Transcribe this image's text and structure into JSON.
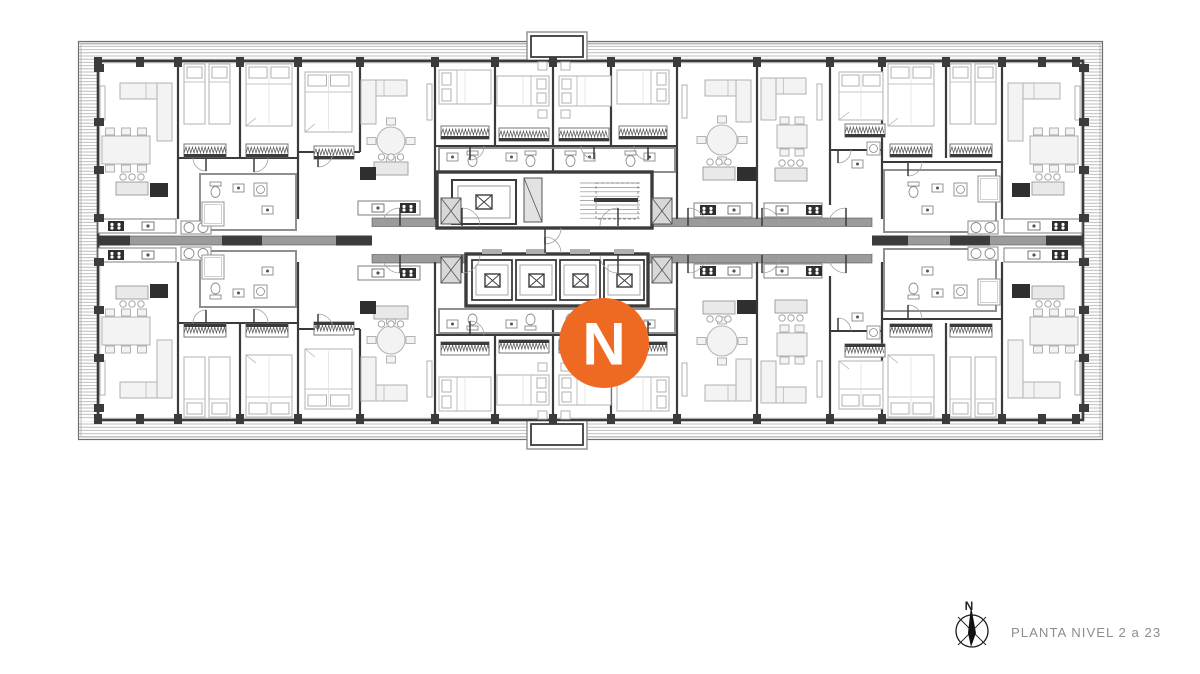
{
  "legend": {
    "title": "PLANTA NIVEL 2 a 23",
    "compass_label": "N"
  },
  "logo": {
    "letter": "N"
  },
  "colors": {
    "background": "#ffffff",
    "wall_dark": "#3b3b3b",
    "wall_gray": "#9b9b9b",
    "furn_line": "#b2b2b2",
    "furn_fill": "#f3f3f3",
    "hatch_line": "#ababab",
    "badge_orange": "#EE6A23",
    "badge_letter": "#ffffff",
    "caption_gray": "#8d8d8d",
    "compass_ink": "#1c1c1c"
  },
  "plan": {
    "outer": [
      78,
      41,
      1025,
      399
    ],
    "band": 20,
    "facade": [
      98,
      61,
      985,
      359
    ],
    "mirror_axis_y": 240.5,
    "bumpouts": [
      [
        527,
        32,
        60,
        29
      ],
      [
        527,
        420,
        60,
        29
      ]
    ],
    "spine": {
      "left": [
        98,
        236,
        274,
        9
      ],
      "right": [
        872,
        236,
        211,
        9
      ],
      "dark_chunks": [
        [
          98,
          32
        ],
        [
          222,
          40
        ],
        [
          336,
          36
        ],
        [
          872,
          36
        ],
        [
          950,
          40
        ],
        [
          1046,
          37
        ]
      ]
    },
    "corridor": {
      "rect": [
        372,
        227,
        500,
        27
      ],
      "walls": [
        [
          372,
          218,
          500,
          9
        ],
        [
          372,
          254,
          500,
          9
        ]
      ]
    },
    "core": {
      "top_block": [
        437,
        172,
        215,
        56
      ],
      "elevator_top": [
        452,
        180,
        64,
        44
      ],
      "duct": [
        524,
        178,
        18,
        44
      ],
      "stair": [
        578,
        178,
        64,
        46
      ],
      "bottom_block": [
        466,
        254,
        182,
        52
      ],
      "shaft_count": 4,
      "shaft_start_x": 472,
      "shaft_step": 44,
      "shaft_w": 40,
      "x_shafts": [
        [
          441,
          198,
          20,
          26
        ],
        [
          652,
          198,
          20,
          26
        ],
        [
          441,
          257,
          20,
          26
        ],
        [
          652,
          257,
          20,
          26
        ]
      ]
    },
    "walls_v": [
      [
        178,
        61,
        219
      ],
      [
        240,
        61,
        158
      ],
      [
        298,
        61,
        219
      ],
      [
        360,
        61,
        152
      ],
      [
        435,
        61,
        219
      ],
      [
        495,
        61,
        146
      ],
      [
        553,
        61,
        172
      ],
      [
        611,
        61,
        146
      ],
      [
        677,
        61,
        219
      ],
      [
        757,
        61,
        219
      ],
      [
        830,
        61,
        205
      ],
      [
        882,
        61,
        219
      ],
      [
        946,
        61,
        158
      ],
      [
        1002,
        61,
        219
      ]
    ],
    "walls_h": [
      [
        178,
        298,
        158
      ],
      [
        298,
        360,
        152
      ],
      [
        435,
        677,
        146
      ],
      [
        830,
        882,
        150
      ],
      [
        882,
        1002,
        162
      ]
    ],
    "gray_rects": [
      [
        200,
        174,
        96,
        56
      ],
      [
        884,
        170,
        112,
        62
      ],
      [
        439,
        148,
        236,
        24
      ]
    ],
    "columns": {
      "facade_xs": [
        98,
        140,
        178,
        240,
        298,
        360,
        435,
        495,
        553,
        611,
        677,
        757,
        830,
        882,
        946,
        1002,
        1042,
        1076
      ],
      "top_y": 57,
      "bottom_y": 414,
      "side_ys": [
        68,
        122,
        170,
        218,
        262,
        310,
        358,
        408
      ],
      "left_x": 94,
      "right_x": 1079
    },
    "furniture": [
      [
        "tv",
        100,
        86,
        5,
        34
      ],
      [
        "sofa",
        120,
        83,
        52,
        58,
        "R"
      ],
      [
        "table6",
        102,
        136,
        48,
        28
      ],
      [
        "isl",
        116,
        182,
        32,
        13
      ],
      [
        "dk",
        150,
        183,
        18,
        14
      ],
      [
        "ctr",
        98,
        219,
        78,
        10,
        44
      ],
      [
        "oo",
        181,
        221,
        30,
        13
      ],
      [
        "beds2",
        184,
        64,
        46,
        60
      ],
      [
        "bedv",
        246,
        64,
        46,
        62
      ],
      [
        "ward",
        184,
        144,
        42
      ],
      [
        "ward",
        246,
        144,
        42
      ],
      [
        "wc",
        210,
        182
      ],
      [
        "sink",
        233,
        184
      ],
      [
        "wm",
        254,
        183
      ],
      [
        "sink",
        262,
        206
      ],
      [
        "shower",
        202,
        202,
        22,
        24
      ],
      [
        "bedv",
        305,
        72,
        47,
        60
      ],
      [
        "ward",
        314,
        146,
        40
      ],
      [
        "tv",
        427,
        84,
        5,
        36
      ],
      [
        "sofa",
        361,
        80,
        46,
        44,
        "L"
      ],
      [
        "tabler",
        391,
        141,
        14
      ],
      [
        "isl",
        374,
        162,
        34,
        13
      ],
      [
        "dk",
        360,
        167,
        16,
        13
      ],
      [
        "ctr",
        358,
        201,
        62,
        42,
        14
      ],
      [
        "bedh",
        439,
        70,
        52,
        34,
        "l"
      ],
      [
        "ward",
        441,
        126,
        48
      ],
      [
        "sink",
        447,
        153
      ],
      [
        "wc",
        467,
        151
      ],
      [
        "bedh",
        497,
        76,
        52,
        30,
        "r"
      ],
      [
        "ns",
        538,
        62
      ],
      [
        "ns",
        538,
        110
      ],
      [
        "ward",
        499,
        128,
        50
      ],
      [
        "sink",
        506,
        153
      ],
      [
        "wc",
        525,
        151
      ],
      [
        "bedh",
        559,
        76,
        52,
        30,
        "l"
      ],
      [
        "ns",
        561,
        62
      ],
      [
        "ns",
        561,
        110
      ],
      [
        "ward",
        559,
        128,
        50
      ],
      [
        "sink",
        584,
        153
      ],
      [
        "wc",
        565,
        151
      ],
      [
        "bedh",
        617,
        70,
        52,
        34,
        "r"
      ],
      [
        "ward",
        619,
        126,
        48
      ],
      [
        "sink",
        644,
        153
      ],
      [
        "wc",
        625,
        151
      ],
      [
        "tv",
        682,
        85,
        5,
        33
      ],
      [
        "sofa",
        705,
        80,
        46,
        42,
        "R"
      ],
      [
        "tabler",
        722,
        140,
        15
      ],
      [
        "isl",
        703,
        167,
        32,
        13
      ],
      [
        "dk",
        737,
        167,
        19,
        14
      ],
      [
        "ctr",
        694,
        203,
        58,
        6,
        34
      ],
      [
        "tv",
        817,
        84,
        5,
        36
      ],
      [
        "sofa",
        761,
        78,
        45,
        42,
        "L"
      ],
      [
        "table4",
        777,
        125,
        30,
        23
      ],
      [
        "isl",
        775,
        168,
        32,
        13
      ],
      [
        "ctr",
        764,
        203,
        58,
        42,
        12
      ],
      [
        "bedv",
        839,
        72,
        44,
        48
      ],
      [
        "ward",
        845,
        124,
        40
      ],
      [
        "wm",
        867,
        142
      ],
      [
        "sink",
        852,
        160
      ],
      [
        "bedv",
        888,
        64,
        46,
        62
      ],
      [
        "beds2",
        950,
        64,
        46,
        60
      ],
      [
        "ward",
        890,
        144,
        42
      ],
      [
        "ward",
        950,
        144,
        42
      ],
      [
        "wc",
        908,
        182
      ],
      [
        "sink",
        932,
        184
      ],
      [
        "wm",
        954,
        183
      ],
      [
        "sink",
        922,
        206
      ],
      [
        "shower",
        978,
        176,
        22,
        26
      ],
      [
        "oo",
        968,
        221,
        30,
        13
      ],
      [
        "tv",
        1075,
        86,
        5,
        34
      ],
      [
        "sofa",
        1008,
        83,
        52,
        58,
        "L"
      ],
      [
        "table6",
        1030,
        136,
        48,
        28
      ],
      [
        "isl",
        1032,
        182,
        32,
        13
      ],
      [
        "dk",
        1012,
        183,
        18,
        14
      ],
      [
        "ctr",
        1004,
        219,
        78,
        48,
        24
      ]
    ],
    "arcs": [
      [
        400,
        226,
        18,
        "nw"
      ],
      [
        462,
        226,
        18,
        "ne"
      ],
      [
        618,
        226,
        18,
        "nw"
      ],
      [
        688,
        226,
        18,
        "ne"
      ],
      [
        762,
        226,
        18,
        "ne"
      ],
      [
        846,
        226,
        18,
        "nw"
      ],
      [
        545,
        228,
        16,
        "se"
      ],
      [
        318,
        152,
        15,
        "se"
      ],
      [
        470,
        146,
        14,
        "se"
      ],
      [
        594,
        146,
        13,
        "sw"
      ],
      [
        648,
        146,
        14,
        "sw"
      ],
      [
        838,
        150,
        13,
        "se"
      ],
      [
        908,
        162,
        14,
        "se"
      ],
      [
        254,
        158,
        14,
        "se"
      ],
      [
        206,
        158,
        13,
        "sw"
      ]
    ],
    "badge": {
      "cx": 604,
      "cy": 343,
      "r": 45
    },
    "compass": {
      "cx": 972,
      "cy": 631,
      "r": 16,
      "label_x": 969,
      "label_y": 610
    },
    "caption_pos": {
      "x": 1011,
      "y": 637
    }
  }
}
